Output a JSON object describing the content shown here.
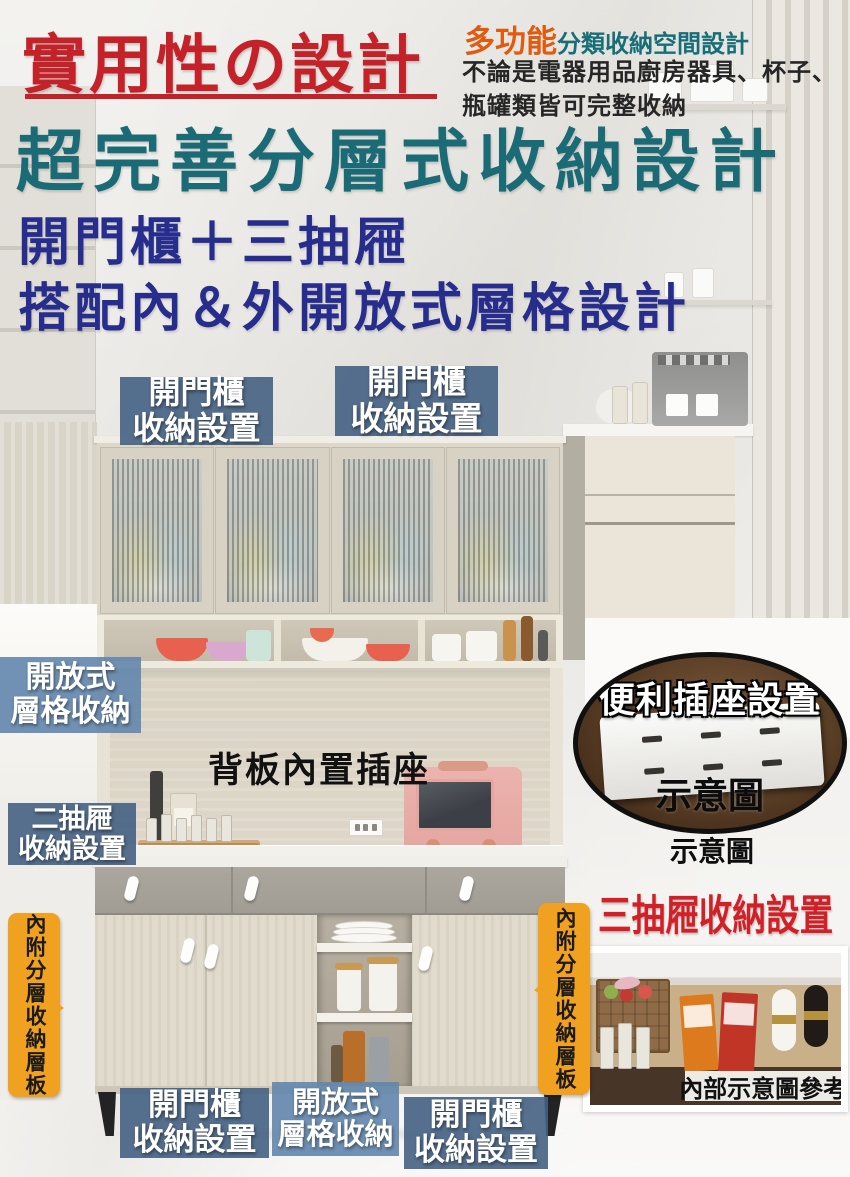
{
  "header": {
    "title": "實用性の設計",
    "badge": "多功能",
    "badge_suffix": "分類收納空間設計",
    "desc1": "不論是電器用品廚房器具、杯子、",
    "desc2": "瓶罐類皆可完整收納",
    "headline": "超完善分層式收納設計",
    "sub1": "開門櫃＋三抽屜",
    "sub2": "搭配內＆外開放式層格設計"
  },
  "callouts": {
    "hutch_left": {
      "l1": "開門櫃",
      "l2": "收納設置"
    },
    "hutch_right": {
      "l1": "開門櫃",
      "l2": "收納設置"
    },
    "open_shelf": {
      "l1": "開放式",
      "l2": "層格收納"
    },
    "back_panel": "背板內置插座",
    "two_drawer": {
      "l1": "二抽屜",
      "l2": "收納設置"
    },
    "socket_title": "便利插座設置",
    "socket_caption": "示意圖",
    "socket_caption_below": "示意圖",
    "three_drawer": "三抽屜收納設置",
    "drawer_caption": "內部示意圖參考",
    "side_left": "內附分層收納層板",
    "side_right": "內附分層收納層板",
    "base_left": {
      "l1": "開門櫃",
      "l2": "收納設置"
    },
    "base_mid": {
      "l1": "開放式",
      "l2": "層格收納"
    },
    "base_right": {
      "l1": "開門櫃",
      "l2": "收納設置"
    }
  },
  "colors": {
    "title_red": "#c42129",
    "headline_teal": "#1b6b76",
    "subtitle_navy": "#272d8d",
    "badge_orange": "#e05a10",
    "label_dark_blue": "#446083",
    "label_light_blue": "#6286ad",
    "tag_orange": "#f1a120",
    "three_drawer_red": "#d31f26"
  }
}
